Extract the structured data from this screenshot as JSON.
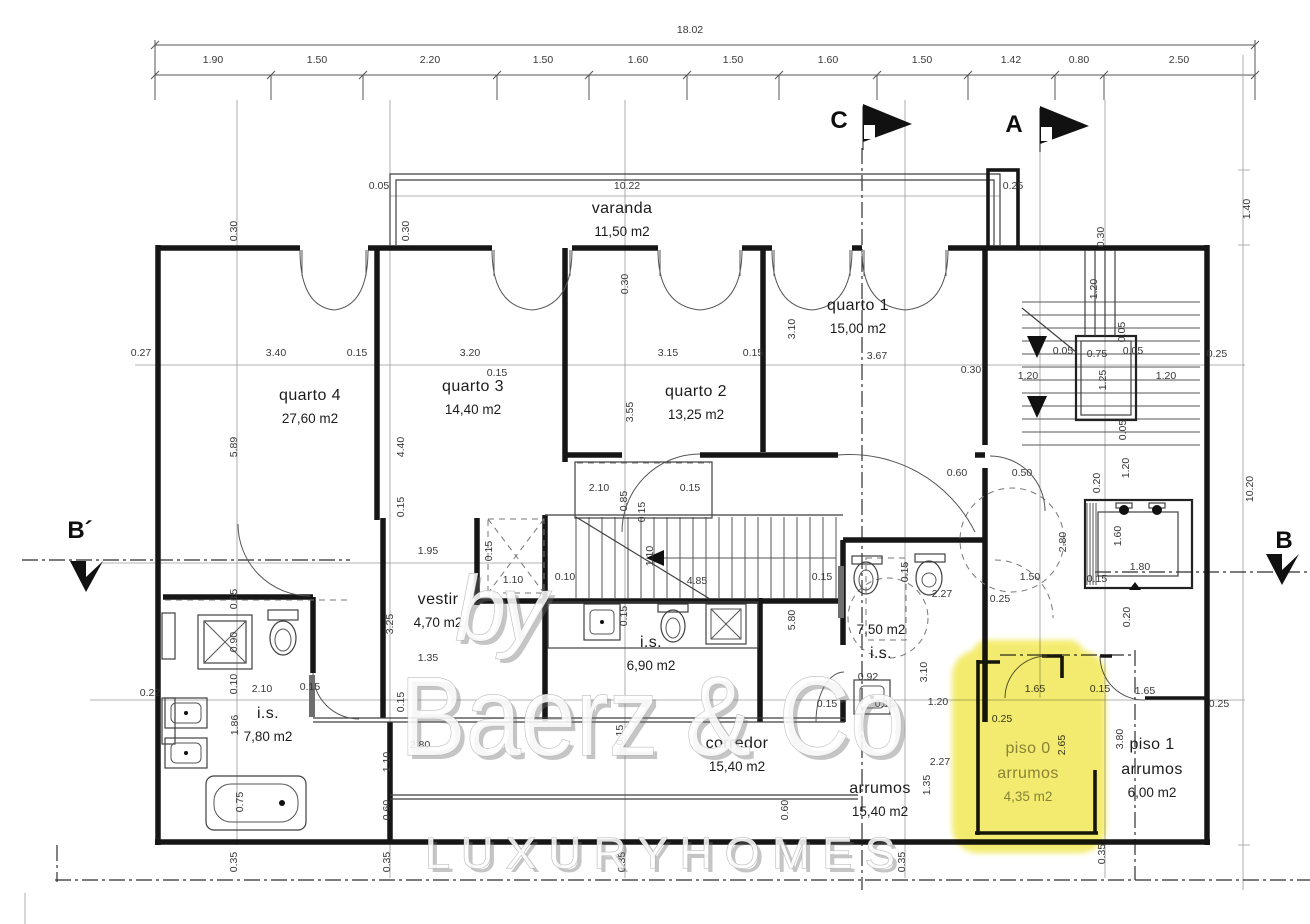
{
  "markers": {
    "section_c": "C",
    "section_a": "A",
    "section_b_left": "B´",
    "section_b_right": "B"
  },
  "watermark": {
    "by_text": "by",
    "brand_text": "Baerz & Co",
    "tagline_text": "L U X U R Y   H O M E S"
  },
  "highlight": {
    "color": "#f1e74b"
  },
  "rooms": [
    {
      "name": "varanda",
      "area": "11,50 m2",
      "x": 622,
      "y": 213
    },
    {
      "name": "quarto 1",
      "area": "15,00 m2",
      "x": 858,
      "y": 310
    },
    {
      "name": "quarto 4",
      "area": "27,60 m2",
      "x": 310,
      "y": 400
    },
    {
      "name": "quarto 3",
      "area": "14,40 m2",
      "x": 473,
      "y": 391
    },
    {
      "name": "quarto 2",
      "area": "13,25 m2",
      "x": 696,
      "y": 396
    },
    {
      "name": "vestir",
      "area": "4,70 m2",
      "x": 438,
      "y": 604
    },
    {
      "name": "i.s.",
      "area": "6,90 m2",
      "x": 651,
      "y": 647
    },
    {
      "name": "i.s.",
      "area": "7,80 m2",
      "x": 268,
      "y": 718
    },
    {
      "name": "i.s.",
      "area": "7,50 m2",
      "x": 881,
      "y": 634,
      "area_above": true
    },
    {
      "name": "corredor",
      "area": "15,40 m2",
      "x": 737,
      "y": 748
    },
    {
      "name": "arrumos",
      "area": "15,40 m2",
      "x": 880,
      "y": 793
    },
    {
      "prefix": "piso 0",
      "name": "arrumos",
      "area": "4,35 m2",
      "x": 1028,
      "y": 753,
      "muted": true
    },
    {
      "prefix": "piso 1",
      "name": "arrumos",
      "area": "6,00 m2",
      "x": 1152,
      "y": 749
    }
  ],
  "dimension_labels": [
    {
      "v": "18.02",
      "x": 690,
      "y": 33
    },
    {
      "v": "1.90",
      "x": 213,
      "y": 63
    },
    {
      "v": "1.50",
      "x": 317,
      "y": 63
    },
    {
      "v": "2.20",
      "x": 430,
      "y": 63
    },
    {
      "v": "1.50",
      "x": 543,
      "y": 63
    },
    {
      "v": "1.60",
      "x": 638,
      "y": 63
    },
    {
      "v": "1.50",
      "x": 733,
      "y": 63
    },
    {
      "v": "1.60",
      "x": 828,
      "y": 63
    },
    {
      "v": "1.50",
      "x": 922,
      "y": 63
    },
    {
      "v": "1.42",
      "x": 1011,
      "y": 63
    },
    {
      "v": "0.80",
      "x": 1079,
      "y": 63
    },
    {
      "v": "2.50",
      "x": 1179,
      "y": 63
    },
    {
      "v": "0.05",
      "x": 379,
      "y": 189
    },
    {
      "v": "10.22",
      "x": 627,
      "y": 189
    },
    {
      "v": "0.25",
      "x": 1013,
      "y": 189
    },
    {
      "v": "0.30",
      "x": 237,
      "y": 231,
      "r": 1
    },
    {
      "v": "0.30",
      "x": 409,
      "y": 231,
      "r": 1
    },
    {
      "v": "0.30",
      "x": 628,
      "y": 284,
      "r": 1
    },
    {
      "v": "0.30",
      "x": 1104,
      "y": 237,
      "r": 1
    },
    {
      "v": "1.40",
      "x": 1250,
      "y": 209,
      "r": 1
    },
    {
      "v": "0.27",
      "x": 141,
      "y": 356
    },
    {
      "v": "3.40",
      "x": 276,
      "y": 356
    },
    {
      "v": "0.15",
      "x": 357,
      "y": 356
    },
    {
      "v": "3.20",
      "x": 470,
      "y": 356
    },
    {
      "v": "0.15",
      "x": 497,
      "y": 376
    },
    {
      "v": "3.15",
      "x": 668,
      "y": 356
    },
    {
      "v": "0.15",
      "x": 753,
      "y": 356
    },
    {
      "v": "3.67",
      "x": 877,
      "y": 359
    },
    {
      "v": "0.30",
      "x": 971,
      "y": 373
    },
    {
      "v": "3.10",
      "x": 795,
      "y": 329,
      "r": 1
    },
    {
      "v": "5.89",
      "x": 237,
      "y": 447,
      "r": 1
    },
    {
      "v": "4.40",
      "x": 404,
      "y": 447,
      "r": 1
    },
    {
      "v": "3.55",
      "x": 633,
      "y": 412,
      "r": 1
    },
    {
      "v": "1.95",
      "x": 428,
      "y": 554
    },
    {
      "v": "0.15",
      "x": 404,
      "y": 507,
      "r": 1
    },
    {
      "v": "0.15",
      "x": 492,
      "y": 551,
      "r": 1
    },
    {
      "v": "1.10",
      "x": 513,
      "y": 583
    },
    {
      "v": "0.10",
      "x": 565,
      "y": 580
    },
    {
      "v": "4.85",
      "x": 697,
      "y": 584
    },
    {
      "v": "1.10",
      "x": 653,
      "y": 556,
      "r": 1
    },
    {
      "v": "5.80",
      "x": 795,
      "y": 620,
      "r": 1
    },
    {
      "v": "0.15",
      "x": 627,
      "y": 616,
      "r": 1
    },
    {
      "v": "3.25",
      "x": 393,
      "y": 624,
      "r": 1
    },
    {
      "v": "1.35",
      "x": 428,
      "y": 661
    },
    {
      "v": "1.10",
      "x": 390,
      "y": 762,
      "r": 1
    },
    {
      "v": "0.60",
      "x": 390,
      "y": 810,
      "r": 1
    },
    {
      "v": "2.80",
      "x": 420,
      "y": 748
    },
    {
      "v": "0.15",
      "x": 404,
      "y": 702,
      "r": 1
    },
    {
      "v": "2.10",
      "x": 599,
      "y": 491
    },
    {
      "v": "0.85",
      "x": 627,
      "y": 501,
      "r": 1
    },
    {
      "v": "0.15",
      "x": 690,
      "y": 491
    },
    {
      "v": "0.15",
      "x": 645,
      "y": 512,
      "r": 1
    },
    {
      "v": "0.60",
      "x": 957,
      "y": 476
    },
    {
      "v": "0.50",
      "x": 1022,
      "y": 476
    },
    {
      "v": "0.15",
      "x": 237,
      "y": 599,
      "r": 1
    },
    {
      "v": "0.90",
      "x": 237,
      "y": 642,
      "r": 1
    },
    {
      "v": "0.10",
      "x": 237,
      "y": 684,
      "r": 1
    },
    {
      "v": "2.10",
      "x": 262,
      "y": 692
    },
    {
      "v": "0.15",
      "x": 310,
      "y": 690
    },
    {
      "v": "1.86",
      "x": 238,
      "y": 725,
      "r": 1
    },
    {
      "v": "0.75",
      "x": 243,
      "y": 802,
      "r": 1
    },
    {
      "v": "0.22",
      "x": 150,
      "y": 696
    },
    {
      "v": "0.15",
      "x": 822,
      "y": 580
    },
    {
      "v": "0.15",
      "x": 908,
      "y": 572,
      "r": 1
    },
    {
      "v": "2.27",
      "x": 942,
      "y": 597
    },
    {
      "v": "0.25",
      "x": 1000,
      "y": 602
    },
    {
      "v": "1.50",
      "x": 1030,
      "y": 580
    },
    {
      "v": "3.10",
      "x": 927,
      "y": 672,
      "r": 1
    },
    {
      "v": "0.92",
      "x": 868,
      "y": 680
    },
    {
      "v": "0.15",
      "x": 827,
      "y": 707
    },
    {
      "v": "0.15",
      "x": 885,
      "y": 707
    },
    {
      "v": "1.20",
      "x": 938,
      "y": 705
    },
    {
      "v": "1.35",
      "x": 930,
      "y": 785,
      "r": 1
    },
    {
      "v": "2.27",
      "x": 940,
      "y": 765
    },
    {
      "v": "0.60",
      "x": 788,
      "y": 810,
      "r": 1
    },
    {
      "v": "0.15",
      "x": 623,
      "y": 735,
      "r": 1
    },
    {
      "v": "1.20",
      "x": 1097,
      "y": 289,
      "r": 1
    },
    {
      "v": "0.05",
      "x": 1125,
      "y": 332,
      "r": 1
    },
    {
      "v": "0.05",
      "x": 1063,
      "y": 354
    },
    {
      "v": "0.75",
      "x": 1097,
      "y": 357
    },
    {
      "v": "0.05",
      "x": 1133,
      "y": 354
    },
    {
      "v": "1.20",
      "x": 1028,
      "y": 379
    },
    {
      "v": "1.25",
      "x": 1106,
      "y": 380,
      "r": 1
    },
    {
      "v": "1.20",
      "x": 1166,
      "y": 379
    },
    {
      "v": "0.25",
      "x": 1217,
      "y": 357
    },
    {
      "v": "0.05",
      "x": 1126,
      "y": 430,
      "r": 1
    },
    {
      "v": "1.20",
      "x": 1129,
      "y": 468,
      "r": 1
    },
    {
      "v": "0.20",
      "x": 1100,
      "y": 483,
      "r": 1
    },
    {
      "v": "1.60",
      "x": 1121,
      "y": 536,
      "r": 1
    },
    {
      "v": "1.80",
      "x": 1140,
      "y": 570
    },
    {
      "v": "2.80",
      "x": 1066,
      "y": 542,
      "r": 1
    },
    {
      "v": "0.15",
      "x": 1097,
      "y": 582
    },
    {
      "v": "0.20",
      "x": 1130,
      "y": 617,
      "r": 1
    },
    {
      "v": "10.20",
      "x": 1253,
      "y": 489,
      "r": 1
    },
    {
      "v": "1.65",
      "x": 1035,
      "y": 692
    },
    {
      "v": "0.15",
      "x": 1100,
      "y": 692
    },
    {
      "v": "1.65",
      "x": 1145,
      "y": 694
    },
    {
      "v": "2.65",
      "x": 1065,
      "y": 745,
      "r": 1
    },
    {
      "v": "3.80",
      "x": 1123,
      "y": 739,
      "r": 1
    },
    {
      "v": "0.35",
      "x": 1105,
      "y": 854,
      "r": 1
    },
    {
      "v": "0.25",
      "x": 1002,
      "y": 722
    },
    {
      "v": "0.35",
      "x": 237,
      "y": 862,
      "r": 1
    },
    {
      "v": "0.35",
      "x": 390,
      "y": 862,
      "r": 1
    },
    {
      "v": "0.35",
      "x": 625,
      "y": 862,
      "r": 1
    },
    {
      "v": "0.35",
      "x": 905,
      "y": 862,
      "r": 1
    },
    {
      "v": "0.25",
      "x": 1219,
      "y": 707
    }
  ]
}
